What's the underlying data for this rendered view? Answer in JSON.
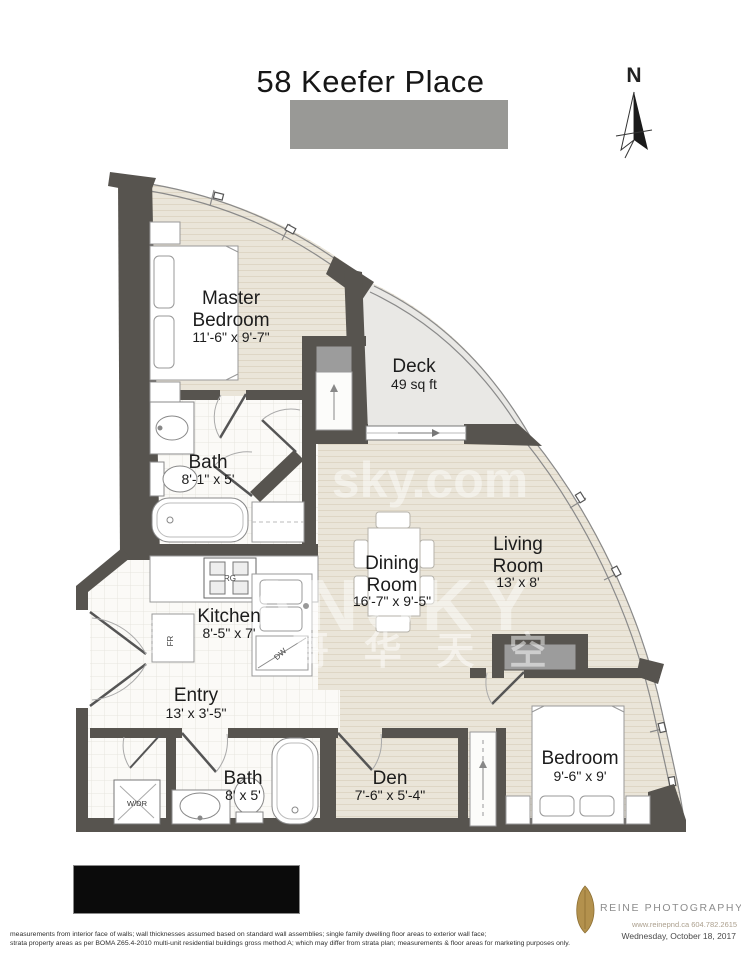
{
  "title": "58 Keefer Place",
  "compass": {
    "label": "N"
  },
  "rooms": {
    "master": {
      "line1": "Master",
      "line2": "Bedroom",
      "dims": "11'-6\" x 9'-7\""
    },
    "deck": {
      "line1": "Deck",
      "dims": "49 sq ft"
    },
    "bath1": {
      "line1": "Bath",
      "dims": "8'-1\" x 5'"
    },
    "kitchen": {
      "line1": "Kitchen",
      "dims": "8'-5\" x 7'"
    },
    "dining": {
      "line1": "Dining",
      "line2": "Room",
      "dims": "16'-7\" x 9'-5\""
    },
    "living": {
      "line1": "Living",
      "line2": "Room",
      "dims": "13' x 8'"
    },
    "entry": {
      "line1": "Entry",
      "dims": "13' x 3'-5\""
    },
    "bath2": {
      "line1": "Bath",
      "dims": "8' x 5'"
    },
    "den": {
      "line1": "Den",
      "dims": "7'-6\" x 5'-4\""
    },
    "bedroom": {
      "line1": "Bedroom",
      "dims": "9'-6\" x 9'"
    }
  },
  "appliances": {
    "range": "RG",
    "fridge": "FR",
    "dishwasher": "DW",
    "washer_dryer": "W/DR"
  },
  "watermark": {
    "url": "sky.com",
    "brand": "ANSKY",
    "cjk": "哥 华 天 空"
  },
  "logo": {
    "name": "REINE PHOTOGRAPHY & DESIGN",
    "contact": "www.reinepnd.ca  604.782.2615"
  },
  "footer": {
    "disclaimer_line1": "measurements from interior face of walls; wall thicknesses assumed based on standard wall assemblies; single family dwelling floor areas to exterior wall face;",
    "disclaimer_line2": "strata property areas as per BOMA Z65.4-2010 multi-unit residential buildings gross method A; which may differ from strata plan; measurements & floor areas for marketing purposes only.",
    "date": "Wednesday, October 18, 2017"
  },
  "colors": {
    "wall": "#57544f",
    "wood": "#eae5d9",
    "tile": "#fbfaf7",
    "deck": "#e9e8e5",
    "leaf": "#b3914d",
    "redaction_gray": "#999996",
    "redaction_black": "#0b0b0b"
  }
}
